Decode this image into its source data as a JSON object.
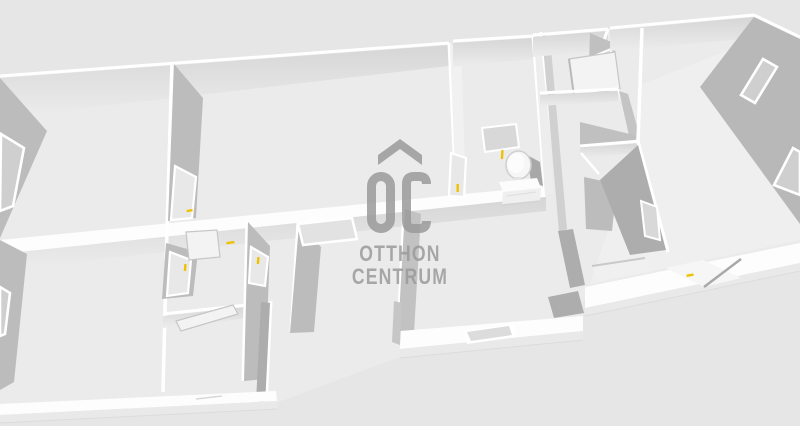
{
  "scene": {
    "description": "3D dollhouse-style floor plan render of an apartment, viewed from above at an angle, with a real-estate watermark in the center",
    "colors": {
      "background": "#e6e6e6",
      "floor": "#ebebeb",
      "floor-bright": "#efefef",
      "wall-top": "#ffffff",
      "wall-band": "#fdfdfd",
      "wall-face": "#e0e0e0",
      "wall-shadow": "#bcbcbc",
      "wall-shadow-dark": "#adadad",
      "window-glass": "#cfcfcf",
      "door-leaf": "#f3f3f3",
      "door-handle": "#eec200",
      "logo": "#9b9b9b"
    },
    "counts": {
      "door_handles_visible": 7,
      "windows_visible": 4,
      "open_door_leaves_visible": 4
    },
    "furniture": [
      "vanity-table",
      "round-mirror"
    ]
  },
  "watermark": {
    "monogram": "OC",
    "line1": "OTTHON",
    "line2": "CENTRUM"
  }
}
